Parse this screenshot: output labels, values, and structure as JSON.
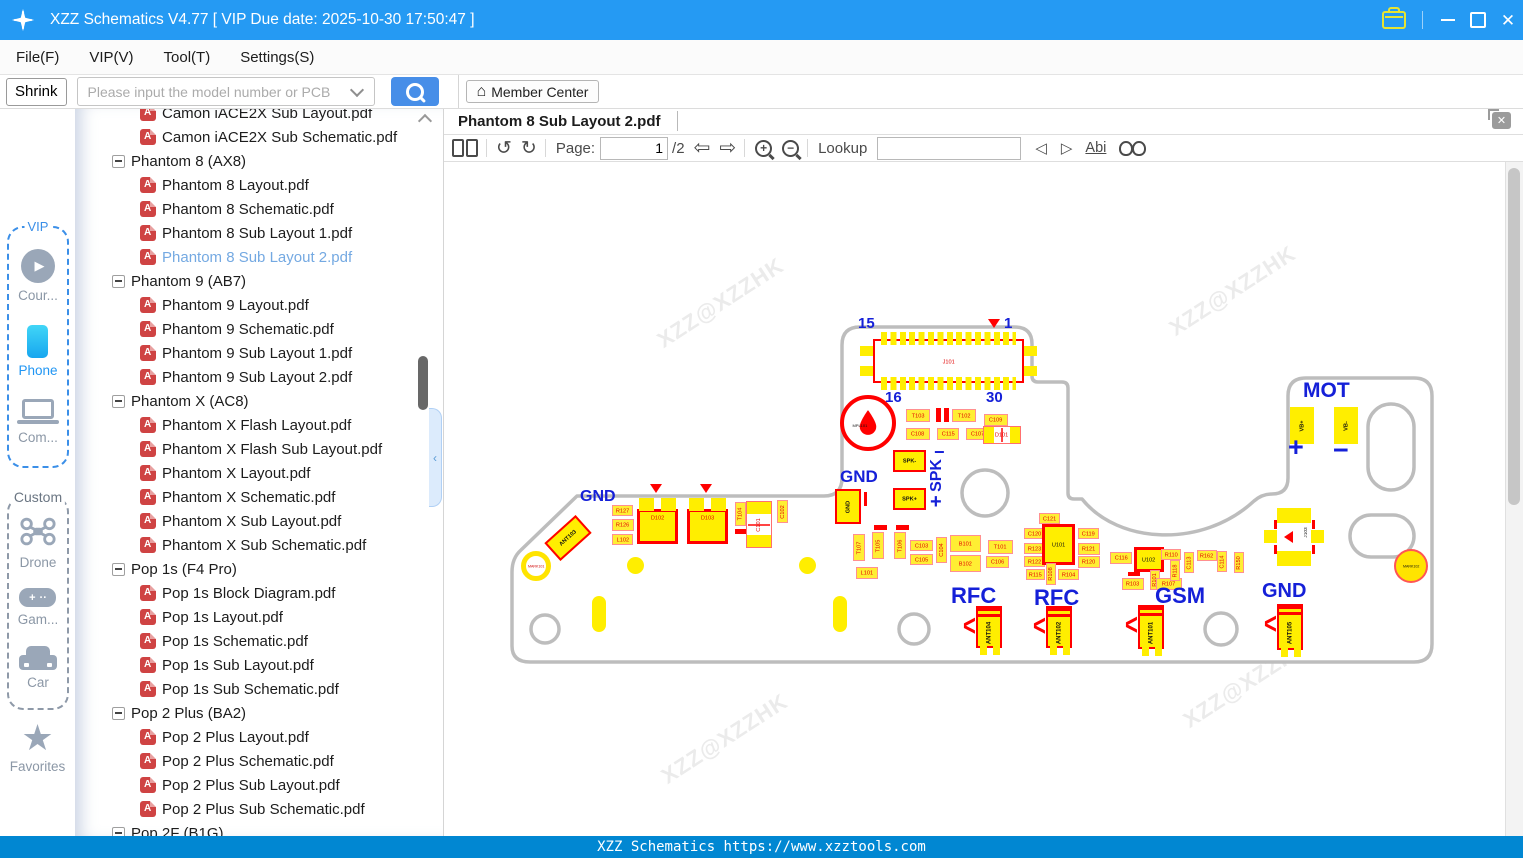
{
  "titlebar": {
    "title": "XZZ Schematics V4.77 [ VIP Due date: 2025-10-30 17:50:47 ]"
  },
  "menubar": {
    "items": [
      "File(F)",
      "VIP(V)",
      "Tool(T)",
      "Settings(S)"
    ]
  },
  "searchbar": {
    "shrink_label": "Shrink",
    "placeholder": "Please input the model number or PCB",
    "member_center_label": "Member Center"
  },
  "sidebar": {
    "groups": [
      {
        "label": "VIP",
        "items": [
          {
            "icon": "play",
            "label": "Cour..."
          },
          {
            "icon": "phone",
            "label": "Phone",
            "active": true
          },
          {
            "icon": "laptop",
            "label": "Com..."
          }
        ]
      },
      {
        "label": "Custom",
        "items": [
          {
            "icon": "drone",
            "label": "Drone"
          },
          {
            "icon": "gamepad",
            "label": "Gam..."
          },
          {
            "icon": "car",
            "label": "Car"
          }
        ]
      }
    ],
    "favorites": {
      "icon": "star",
      "label": "Favorites"
    }
  },
  "tree": {
    "items": [
      {
        "type": "file",
        "label": "Camon iACE2X Sub Layout.pdf"
      },
      {
        "type": "file",
        "label": "Camon iACE2X Sub Schematic.pdf"
      },
      {
        "type": "folder",
        "label": "Phantom 8 (AX8)"
      },
      {
        "type": "file",
        "label": "Phantom 8 Layout.pdf"
      },
      {
        "type": "file",
        "label": "Phantom 8 Schematic.pdf"
      },
      {
        "type": "file",
        "label": "Phantom 8 Sub Layout 1.pdf"
      },
      {
        "type": "file",
        "label": "Phantom 8 Sub Layout 2.pdf",
        "selected": true
      },
      {
        "type": "folder",
        "label": "Phantom 9 (AB7)"
      },
      {
        "type": "file",
        "label": "Phantom 9 Layout.pdf"
      },
      {
        "type": "file",
        "label": "Phantom 9 Schematic.pdf"
      },
      {
        "type": "file",
        "label": "Phantom 9 Sub Layout 1.pdf"
      },
      {
        "type": "file",
        "label": "Phantom 9 Sub Layout 2.pdf"
      },
      {
        "type": "folder",
        "label": "Phantom X (AC8)"
      },
      {
        "type": "file",
        "label": "Phantom X Flash Layout.pdf"
      },
      {
        "type": "file",
        "label": "Phantom X Flash Sub Layout.pdf"
      },
      {
        "type": "file",
        "label": "Phantom X Layout.pdf"
      },
      {
        "type": "file",
        "label": "Phantom X Schematic.pdf"
      },
      {
        "type": "file",
        "label": "Phantom X Sub Layout.pdf"
      },
      {
        "type": "file",
        "label": "Phantom X Sub Schematic.pdf"
      },
      {
        "type": "folder",
        "label": "Pop 1s (F4 Pro)"
      },
      {
        "type": "file",
        "label": "Pop 1s Block Diagram.pdf"
      },
      {
        "type": "file",
        "label": "Pop 1s Layout.pdf"
      },
      {
        "type": "file",
        "label": "Pop 1s Schematic.pdf"
      },
      {
        "type": "file",
        "label": "Pop 1s Sub Layout.pdf"
      },
      {
        "type": "file",
        "label": "Pop 1s Sub Schematic.pdf"
      },
      {
        "type": "folder",
        "label": "Pop 2 Plus (BA2)"
      },
      {
        "type": "file",
        "label": "Pop 2 Plus Layout.pdf"
      },
      {
        "type": "file",
        "label": "Pop 2 Plus Schematic.pdf"
      },
      {
        "type": "file",
        "label": "Pop 2 Plus Sub Layout.pdf"
      },
      {
        "type": "file",
        "label": "Pop 2 Plus Sub Schematic.pdf"
      },
      {
        "type": "folder",
        "label": "Pop 2F (B1G)"
      }
    ]
  },
  "viewer": {
    "tab": "Phantom 8 Sub Layout 2.pdf",
    "toolbar": {
      "page_label": "Page:",
      "page_value": "1",
      "page_total": "/2",
      "lookup_label": "Lookup",
      "lookup_value": "",
      "abi_label": "Abi"
    }
  },
  "statusbar": {
    "text": "XZZ Schematics https://www.xzztools.com"
  },
  "pcb": {
    "watermark": "XZZ@XZZHK",
    "wm": [
      {
        "x": 648,
        "y": 290
      },
      {
        "x": 1160,
        "y": 278
      },
      {
        "x": 652,
        "y": 726
      },
      {
        "x": 1174,
        "y": 670
      }
    ],
    "j101": "J101",
    "mpl": "MPL101",
    "j103": "J103",
    "mark101": "MARK101",
    "mark102": "MARK102",
    "labels": [
      {
        "t": "15",
        "x": 858,
        "y": 316,
        "s": 15
      },
      {
        "t": "1",
        "x": 1004,
        "y": 316,
        "s": 15
      },
      {
        "t": "16",
        "x": 885,
        "y": 390,
        "s": 15
      },
      {
        "t": "30",
        "x": 986,
        "y": 390,
        "s": 15
      },
      {
        "t": "GND",
        "x": 840,
        "y": 468,
        "s": 17
      },
      {
        "t": "−",
        "x": 934,
        "y": 443,
        "s": 18
      },
      {
        "t": "SPK",
        "x": 929,
        "y": 459,
        "s": 16,
        "v": 1
      },
      {
        "t": "+",
        "x": 930,
        "y": 492,
        "s": 20
      },
      {
        "t": "GND",
        "x": 580,
        "y": 489,
        "s": 16
      },
      {
        "t": "MOT",
        "x": 1303,
        "y": 380,
        "s": 21
      },
      {
        "t": "+",
        "x": 1288,
        "y": 434,
        "s": 27
      },
      {
        "t": "−",
        "x": 1333,
        "y": 437,
        "s": 27
      },
      {
        "t": "RFC",
        "x": 951,
        "y": 585,
        "s": 22
      },
      {
        "t": "RFC",
        "x": 1034,
        "y": 587,
        "s": 22
      },
      {
        "t": "GSM",
        "x": 1155,
        "y": 585,
        "s": 22
      },
      {
        "t": "GND",
        "x": 1262,
        "y": 581,
        "s": 20
      }
    ],
    "components": [
      {
        "t": "T103",
        "x": 906,
        "y": 409,
        "w": 24,
        "h": 13,
        "cls": "smd"
      },
      {
        "t": "T102",
        "x": 952,
        "y": 409,
        "w": 24,
        "h": 13,
        "cls": "smd"
      },
      {
        "t": "C109",
        "x": 984,
        "y": 414,
        "w": 24,
        "h": 12,
        "cls": "smd"
      },
      {
        "t": "C108",
        "x": 906,
        "y": 428,
        "w": 24,
        "h": 12,
        "cls": "smd"
      },
      {
        "t": "C115",
        "x": 937,
        "y": 428,
        "w": 22,
        "h": 12,
        "cls": "smd"
      },
      {
        "t": "C107",
        "x": 966,
        "y": 428,
        "w": 24,
        "h": 12,
        "cls": "smd"
      },
      {
        "t": "D101",
        "x": 983,
        "y": 426,
        "w": 38,
        "h": 18,
        "cls": "dpack"
      },
      {
        "t": "GND",
        "x": 835,
        "y": 489,
        "w": 26,
        "h": 35,
        "cls": "padb",
        "v": 1
      },
      {
        "t": "SPK-",
        "x": 893,
        "y": 450,
        "w": 33,
        "h": 22,
        "cls": "padb"
      },
      {
        "t": "SPK+",
        "x": 893,
        "y": 488,
        "w": 33,
        "h": 22,
        "cls": "padb"
      },
      {
        "t": "T107",
        "x": 853,
        "y": 534,
        "w": 12,
        "h": 27,
        "cls": "smd",
        "v": 1
      },
      {
        "t": "T105",
        "x": 872,
        "y": 532,
        "w": 12,
        "h": 27,
        "cls": "smd",
        "v": 1
      },
      {
        "t": "T106",
        "x": 894,
        "y": 532,
        "w": 12,
        "h": 27,
        "cls": "smd",
        "v": 1
      },
      {
        "t": "C103",
        "x": 910,
        "y": 540,
        "w": 23,
        "h": 11,
        "cls": "smd"
      },
      {
        "t": "C105",
        "x": 910,
        "y": 554,
        "w": 23,
        "h": 11,
        "cls": "smd"
      },
      {
        "t": "C104",
        "x": 936,
        "y": 537,
        "w": 11,
        "h": 26,
        "cls": "smd",
        "v": 1
      },
      {
        "t": "B101",
        "x": 950,
        "y": 535,
        "w": 31,
        "h": 17,
        "cls": "smd"
      },
      {
        "t": "B102",
        "x": 950,
        "y": 555,
        "w": 31,
        "h": 17,
        "cls": "smd"
      },
      {
        "t": "T101",
        "x": 988,
        "y": 540,
        "w": 25,
        "h": 14,
        "cls": "smd"
      },
      {
        "t": "C106",
        "x": 986,
        "y": 556,
        "w": 23,
        "h": 12,
        "cls": "smd"
      },
      {
        "t": "L101",
        "x": 856,
        "y": 567,
        "w": 22,
        "h": 12,
        "cls": "smd"
      },
      {
        "t": "ANT103",
        "x": 547,
        "y": 526,
        "w": 42,
        "h": 24,
        "cls": "padb rot45"
      },
      {
        "t": "R127",
        "x": 612,
        "y": 505,
        "w": 21,
        "h": 11,
        "cls": "smd"
      },
      {
        "t": "R126",
        "x": 612,
        "y": 519,
        "w": 22,
        "h": 12,
        "cls": "smd"
      },
      {
        "t": "L102",
        "x": 612,
        "y": 534,
        "w": 21,
        "h": 11,
        "cls": "smd"
      },
      {
        "t": "D102",
        "x": 637,
        "y": 509,
        "w": 41,
        "h": 35,
        "cls": "big"
      },
      {
        "t": "D103",
        "x": 687,
        "y": 509,
        "w": 41,
        "h": 35,
        "cls": "big"
      },
      {
        "t": "T104",
        "x": 735,
        "y": 502,
        "w": 11,
        "h": 24,
        "cls": "smd",
        "v": 1
      },
      {
        "t": "C101",
        "x": 746,
        "y": 501,
        "w": 26,
        "h": 47,
        "cls": "dpack vertg",
        "v": 1
      },
      {
        "t": "C102",
        "x": 777,
        "y": 500,
        "w": 11,
        "h": 23,
        "cls": "smd",
        "v": 1
      },
      {
        "t": "C121",
        "x": 1039,
        "y": 513,
        "w": 21,
        "h": 11,
        "cls": "smd"
      },
      {
        "t": "C120",
        "x": 1024,
        "y": 528,
        "w": 21,
        "h": 11,
        "cls": "smd"
      },
      {
        "t": "R123",
        "x": 1024,
        "y": 543,
        "w": 21,
        "h": 11,
        "cls": "smd"
      },
      {
        "t": "R122",
        "x": 1024,
        "y": 556,
        "w": 21,
        "h": 11,
        "cls": "smd"
      },
      {
        "t": "U101",
        "x": 1042,
        "y": 524,
        "w": 33,
        "h": 41,
        "cls": "ic"
      },
      {
        "t": "C119",
        "x": 1078,
        "y": 528,
        "w": 21,
        "h": 11,
        "cls": "smd"
      },
      {
        "t": "R121",
        "x": 1078,
        "y": 543,
        "w": 22,
        "h": 12,
        "cls": "smd"
      },
      {
        "t": "R120",
        "x": 1078,
        "y": 556,
        "w": 22,
        "h": 12,
        "cls": "smd"
      },
      {
        "t": "R115",
        "x": 1026,
        "y": 569,
        "w": 19,
        "h": 11,
        "cls": "smd"
      },
      {
        "t": "R108",
        "x": 1046,
        "y": 563,
        "w": 10,
        "h": 22,
        "cls": "smd",
        "v": 1
      },
      {
        "t": "R104",
        "x": 1058,
        "y": 569,
        "w": 21,
        "h": 11,
        "cls": "smd"
      },
      {
        "t": "C116",
        "x": 1110,
        "y": 552,
        "w": 22,
        "h": 12,
        "cls": "smd"
      },
      {
        "t": "U102",
        "x": 1134,
        "y": 547,
        "w": 30,
        "h": 25,
        "cls": "ic"
      },
      {
        "t": "R101",
        "x": 1150,
        "y": 570,
        "w": 10,
        "h": 20,
        "cls": "smd",
        "v": 1
      },
      {
        "t": "R103",
        "x": 1122,
        "y": 578,
        "w": 22,
        "h": 12,
        "cls": "smd"
      },
      {
        "t": "R107",
        "x": 1156,
        "y": 578,
        "w": 26,
        "h": 12,
        "cls": "smd"
      },
      {
        "t": "R110",
        "x": 1161,
        "y": 549,
        "w": 20,
        "h": 11,
        "cls": "smd"
      },
      {
        "t": "R118",
        "x": 1170,
        "y": 560,
        "w": 10,
        "h": 21,
        "cls": "smd",
        "v": 1
      },
      {
        "t": "C113",
        "x": 1184,
        "y": 552,
        "w": 10,
        "h": 21,
        "cls": "smd",
        "v": 1
      },
      {
        "t": "R162",
        "x": 1197,
        "y": 550,
        "w": 20,
        "h": 11,
        "cls": "smd"
      },
      {
        "t": "C114",
        "x": 1217,
        "y": 551,
        "w": 10,
        "h": 21,
        "cls": "smd",
        "v": 1
      },
      {
        "t": "R150",
        "x": 1234,
        "y": 552,
        "w": 10,
        "h": 21,
        "cls": "smd",
        "v": 1
      },
      {
        "t": "VB+",
        "x": 1290,
        "y": 407,
        "w": 24,
        "h": 37,
        "cls": "pad",
        "v": 1
      },
      {
        "t": "VB-",
        "x": 1334,
        "y": 407,
        "w": 24,
        "h": 37,
        "cls": "pad",
        "v": 1
      },
      {
        "t": "ANT104",
        "x": 976,
        "y": 606,
        "w": 26,
        "h": 42,
        "cls": "ant"
      },
      {
        "t": "ANT102",
        "x": 1046,
        "y": 606,
        "w": 26,
        "h": 42,
        "cls": "ant"
      },
      {
        "t": "ANT101",
        "x": 1138,
        "y": 605,
        "w": 26,
        "h": 44,
        "cls": "ant"
      },
      {
        "t": "ANT105",
        "x": 1277,
        "y": 604,
        "w": 26,
        "h": 46,
        "cls": "ant"
      }
    ],
    "marks": [
      {
        "cls": "tri",
        "x": 988,
        "y": 319
      },
      {
        "cls": "tri",
        "x": 650,
        "y": 484
      },
      {
        "cls": "tri",
        "x": 700,
        "y": 484
      },
      {
        "cls": "redbar",
        "x": 936,
        "y": 408,
        "w": 5,
        "h": 14
      },
      {
        "cls": "redbar",
        "x": 944,
        "y": 408,
        "w": 5,
        "h": 14
      },
      {
        "cls": "redbar",
        "x": 874,
        "y": 525,
        "w": 13,
        "h": 5
      },
      {
        "cls": "redbar",
        "x": 896,
        "y": 525,
        "w": 13,
        "h": 5
      },
      {
        "cls": "redbar",
        "x": 735,
        "y": 529,
        "w": 11,
        "h": 5
      },
      {
        "cls": "redbar",
        "x": 864,
        "y": 492,
        "w": 3,
        "h": 14
      },
      {
        "cls": "redbar",
        "x": 1128,
        "y": 572,
        "w": 12,
        "h": 4
      },
      {
        "cls": "via",
        "x": 627,
        "y": 557,
        "w": 17,
        "h": 17
      },
      {
        "cls": "via",
        "x": 799,
        "y": 557,
        "w": 17,
        "h": 17
      },
      {
        "cls": "pill",
        "x": 592,
        "y": 596,
        "w": 14,
        "h": 36
      },
      {
        "cls": "pill",
        "x": 833,
        "y": 596,
        "w": 14,
        "h": 36
      }
    ]
  }
}
